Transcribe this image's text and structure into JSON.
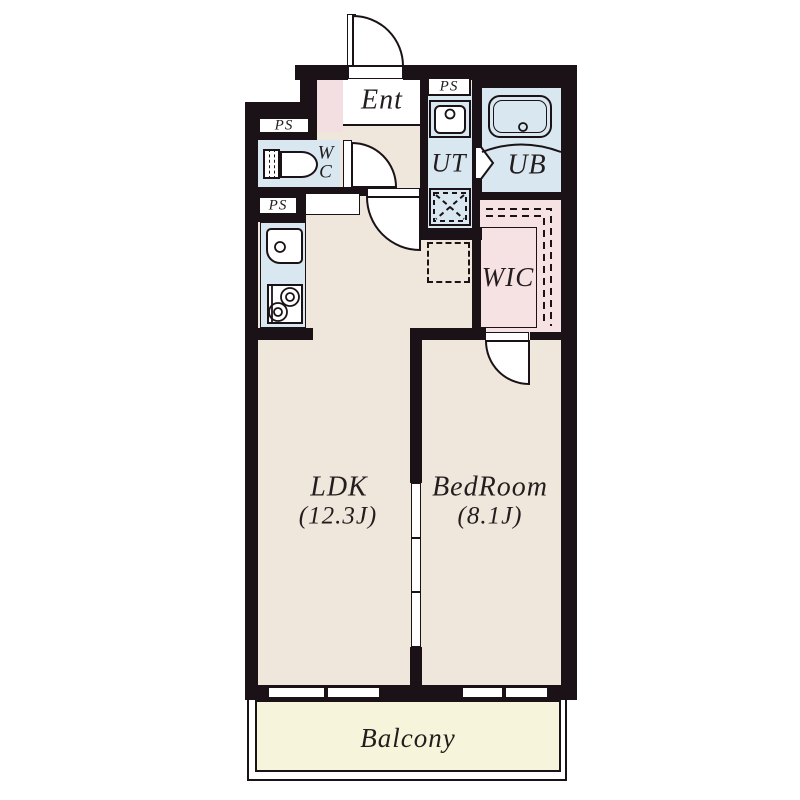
{
  "plan_type": "apartment-floor-plan",
  "rooms": {
    "ent": {
      "label": "Ent"
    },
    "wc": {
      "letters": [
        "W",
        "C"
      ]
    },
    "ut": {
      "label": "UT"
    },
    "ub": {
      "label": "UB"
    },
    "wic": {
      "label": "WIC"
    },
    "ldk": {
      "label": "LDK",
      "size": "(12.3J)"
    },
    "bedroom": {
      "label": "BedRoom",
      "size": "(8.1J)"
    },
    "balcony": {
      "label": "Balcony"
    }
  },
  "ps_labels": {
    "upper_left": "PS",
    "lower_left": "PS",
    "upper_right": "PS"
  },
  "icons": {
    "toilet": "toilet-icon",
    "washbasin": "washbasin-icon",
    "bathtub": "bathtub-icon",
    "kitchen_sink": "kitchen-sink-icon",
    "stove": "stove-icon",
    "washer_pan": "washing-machine-pan-icon",
    "fridge_space": "refrigerator-space-icon",
    "hanger_rail": "hanger-rail-icon",
    "doors": [
      "entrance-door-arc",
      "wc-door-arc",
      "ldk-door-arc",
      "wic-door-arc",
      "bath-folding-door",
      "sliding-door"
    ]
  },
  "colors": {
    "wall": "#1a1216",
    "line": "#1a1216",
    "floor": "#efe7db",
    "wet_area": "#d8e7f0",
    "closet": "#f6e1e3",
    "accent": "#f3dee1",
    "balcony": "#f6f4da"
  }
}
